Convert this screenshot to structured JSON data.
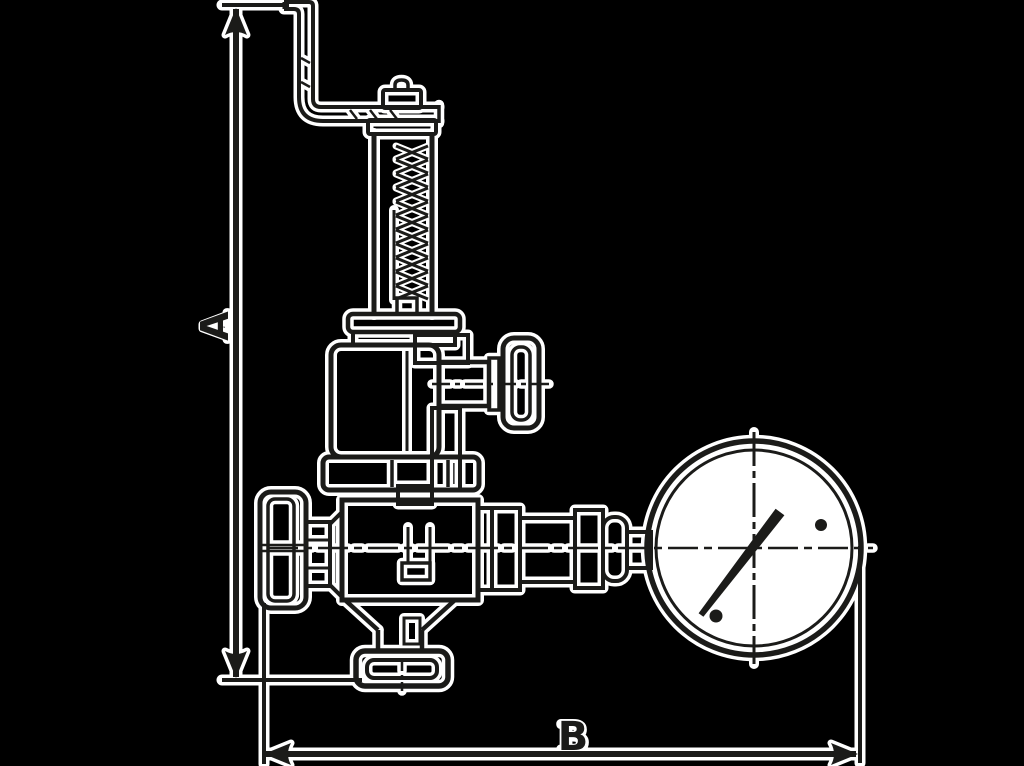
{
  "drawing": {
    "type": "technical-dimension-drawing",
    "subject": "angle safety valve with lift lever, spring bonnet and pressure gauge",
    "labels": {
      "height_dimension": "A",
      "width_dimension": "B"
    }
  },
  "colors": {
    "background": "#000000",
    "ink": "#1b1b19",
    "halo": "#ffffff"
  }
}
